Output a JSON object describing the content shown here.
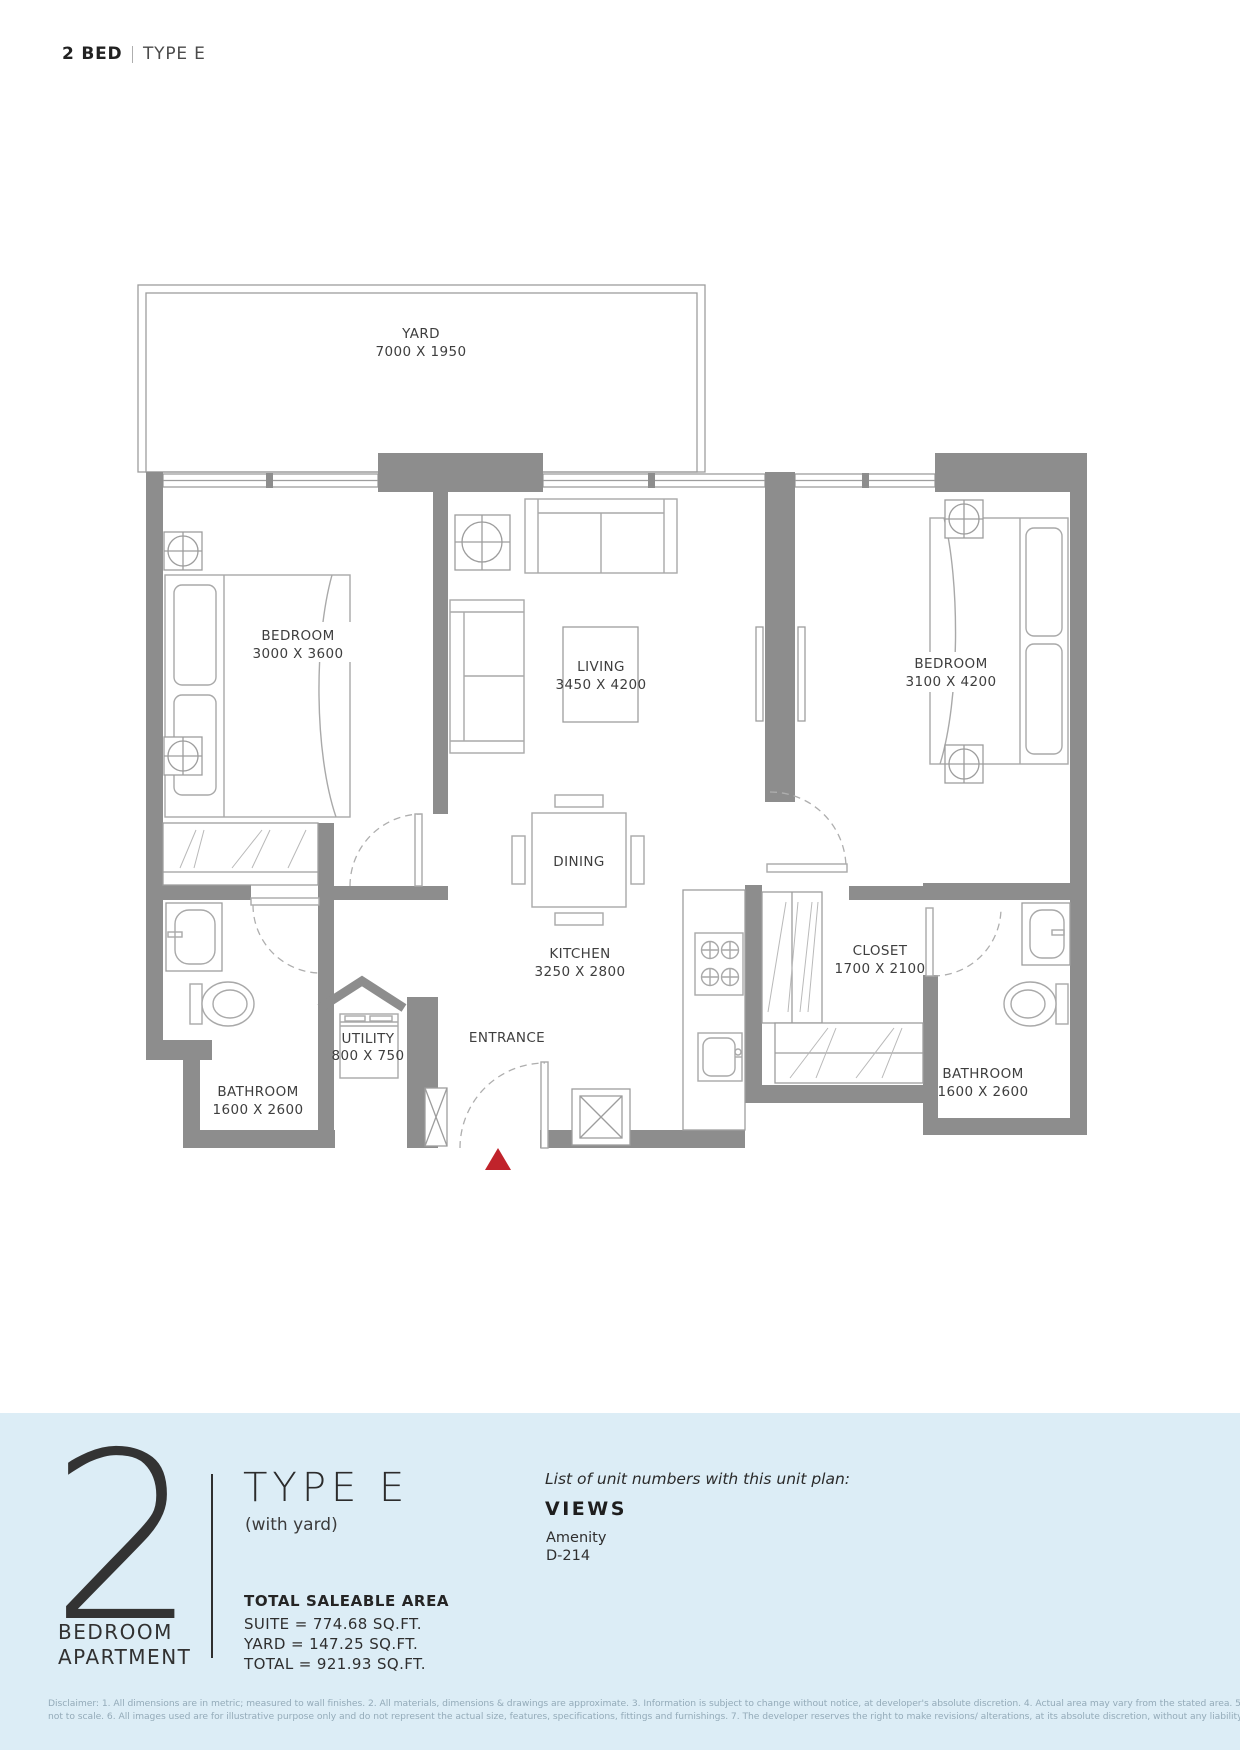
{
  "header": {
    "title_bold": "2 BED",
    "separator": "|",
    "title_light": "TYPE E"
  },
  "plan": {
    "rooms": {
      "yard": {
        "name": "YARD",
        "dims": "7000 X 1950"
      },
      "bedroom1": {
        "name": "BEDROOM",
        "dims": "3000 X 3600"
      },
      "living": {
        "name": "LIVING",
        "dims": "3450 X 4200"
      },
      "bedroom2": {
        "name": "BEDROOM",
        "dims": "3100 X 4200"
      },
      "dining": {
        "name": "DINING"
      },
      "kitchen": {
        "name": "KITCHEN",
        "dims": "3250 X 2800"
      },
      "closet": {
        "name": "CLOSET",
        "dims": "1700 X 2100"
      },
      "utility": {
        "name": "UTILITY",
        "dims": "800 X 750"
      },
      "entrance": {
        "name": "ENTRANCE"
      },
      "bathroom1": {
        "name": "BATHROOM",
        "dims": "1600 X 2600"
      },
      "bathroom2": {
        "name": "BATHROOM",
        "dims": "1600 X 2600"
      }
    },
    "colors": {
      "wall": "#8d8d8d",
      "entry_marker": "#c0232b"
    }
  },
  "footer": {
    "unit_count": "2",
    "unit_label_line1": "BEDROOM",
    "unit_label_line2": "APARTMENT",
    "type_title": "TYPE E",
    "type_subtitle": "(with yard)",
    "units_list_heading": "List of unit numbers with this unit plan:",
    "building_name": "VIEWS",
    "units": [
      "Amenity",
      "D-214"
    ],
    "area_heading": "TOTAL SALEABLE AREA",
    "area_lines": [
      "SUITE = 774.68 SQ.FT.",
      "YARD = 147.25 SQ.FT.",
      "TOTAL = 921.93 SQ.FT."
    ],
    "colors": {
      "panel_bg": "#dcedf6"
    }
  },
  "disclaimer": {
    "line1": "Disclaimer: 1. All dimensions are in metric; measured to wall finishes. 2. All materials, dimensions & drawings are approximate. 3. Information is subject to change without notice, at developer's absolute discretion. 4. Actual area may vary from the stated area. 5. Drawing are",
    "line2": "not to scale. 6. All images used are for illustrative purpose only and do not represent the actual size, features, specifications, fittings and furnishings. 7. The developer reserves the right to make revisions/ alterations, at its absolute discretion, without any liability whatsoever."
  }
}
